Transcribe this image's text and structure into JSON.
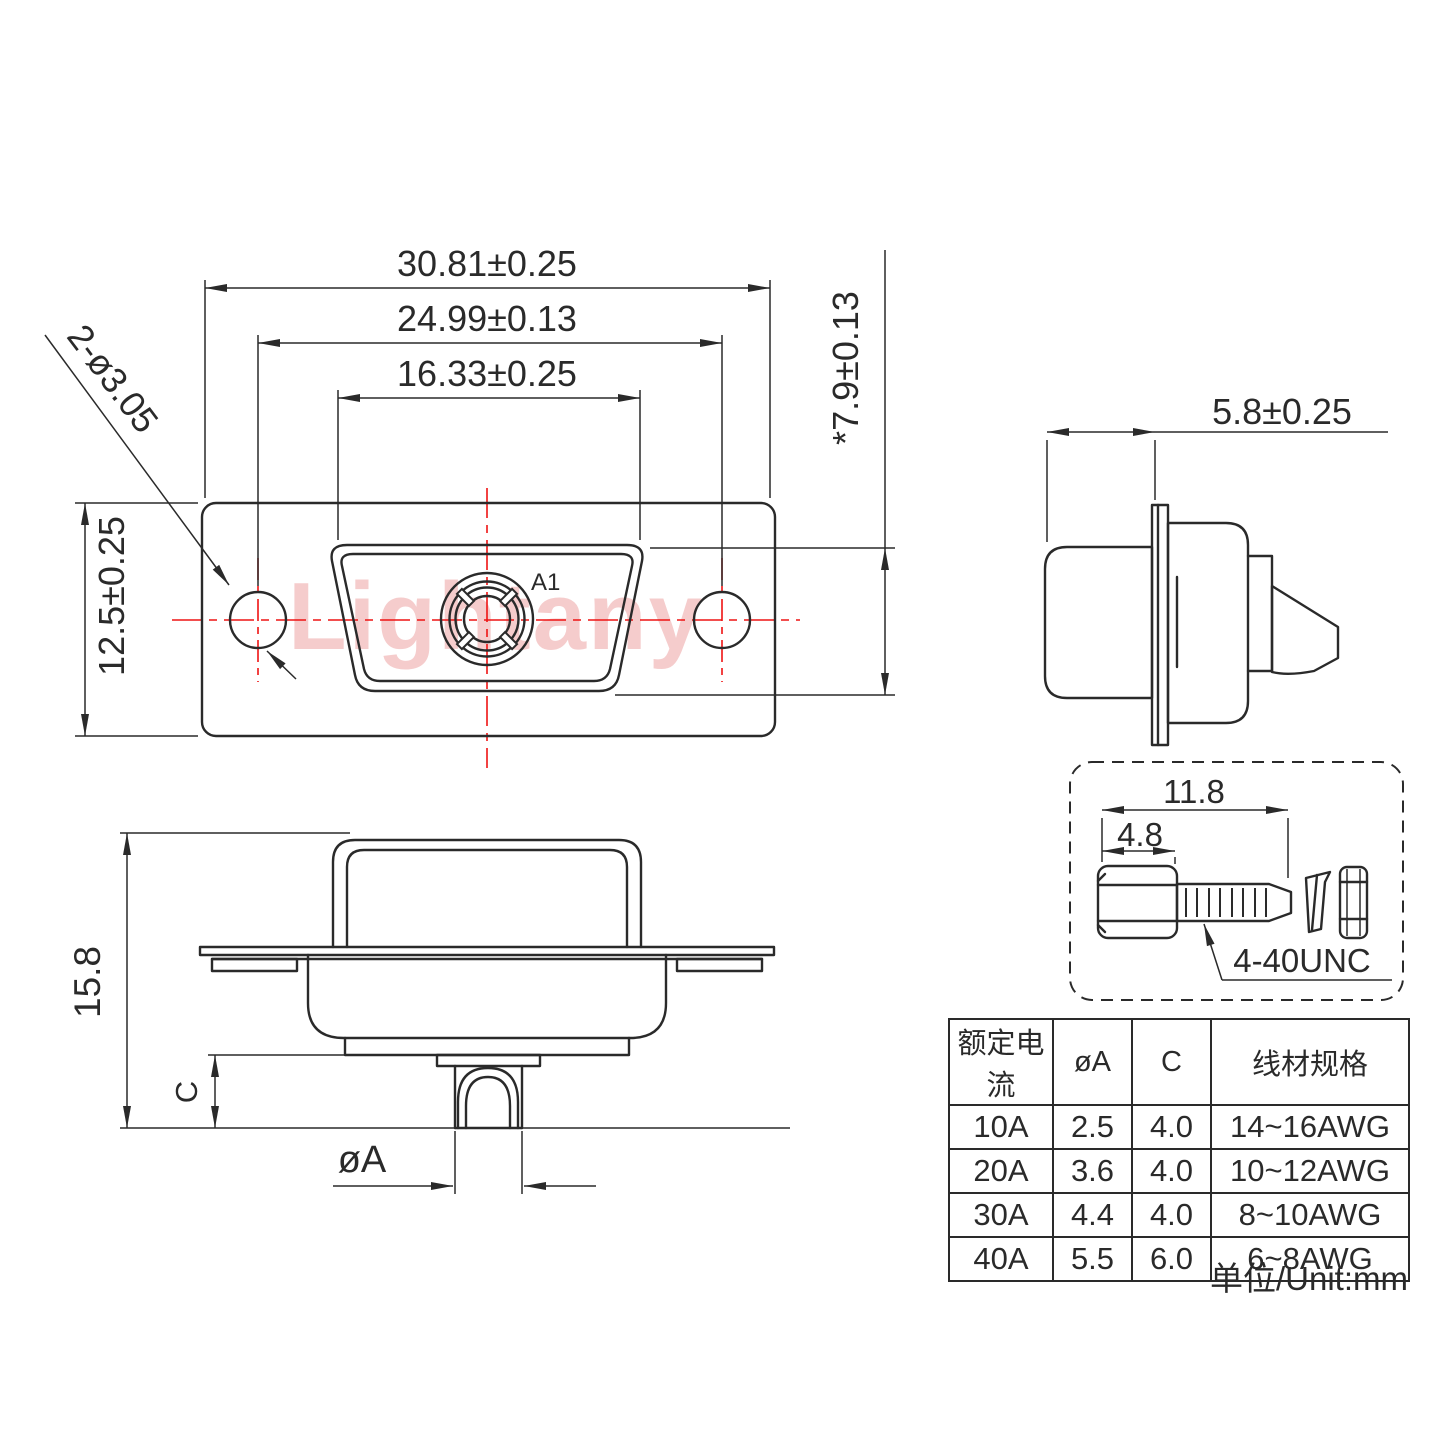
{
  "watermark": {
    "text": "Lightany"
  },
  "front_view": {
    "dims": {
      "outer_width": "30.81±0.25",
      "hole_span": "24.99±0.13",
      "shell_width": "16.33±0.25",
      "flange_height": "12.5±0.25",
      "shell_height": "*7.9±0.13",
      "mount_holes": "2-ø3.05"
    },
    "contact_label": "A1"
  },
  "side_view": {
    "dims": {
      "depth": "5.8±0.25"
    }
  },
  "section_view": {
    "dims": {
      "total_height": "15.8",
      "solder_depth": "C",
      "pin_diameter": "øA"
    }
  },
  "screw_detail": {
    "dims": {
      "total_length": "11.8",
      "head_length": "4.8"
    },
    "thread_spec": "4-40UNC"
  },
  "spec_table": {
    "headers": [
      "额定电流",
      "øA",
      "C",
      "线材规格"
    ],
    "rows": [
      [
        "10A",
        "2.5",
        "4.0",
        "14~16AWG"
      ],
      [
        "20A",
        "3.6",
        "4.0",
        "10~12AWG"
      ],
      [
        "30A",
        "4.4",
        "4.0",
        "8~10AWG"
      ],
      [
        "40A",
        "5.5",
        "6.0",
        "6~8AWG"
      ]
    ]
  },
  "unit_note": "单位/Unit:mm",
  "colors": {
    "line": "#2a2a2a",
    "red_accent": "#ee1313",
    "contact_label_red": "#e60000",
    "watermark_pink": "#dd5555"
  }
}
